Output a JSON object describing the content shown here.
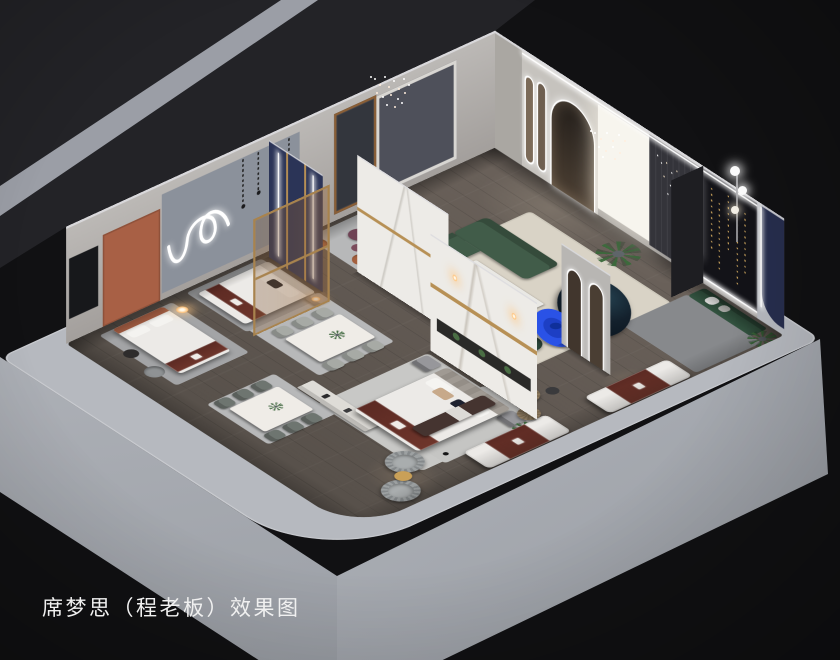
{
  "caption": "席梦思（程老板）效果图",
  "palette": {
    "bg_black": "#111113",
    "bg_charcoal": "#232327",
    "ground_strip": "#9b9ea6",
    "slab": "#b6b9bf",
    "slab_face_sw": "#989ca3",
    "slab_face_se": "#c0c3c9",
    "wood_floor": "#6a615a",
    "wood_dark": "#57504a",
    "wall_light": "#b9b6b3",
    "wall_panel_gray": "#8b919b",
    "white_panel": "#f7f5ee",
    "drape_gray": "#34343a",
    "art_black": "#131318",
    "navy_wall": "#272e4e",
    "navy_panel": "#2b3457",
    "marble_white": "#edebe7",
    "gold": "#b79055",
    "wood_frame": "#8a5f37",
    "rug_cream": "#d9d3c6",
    "rug_gray": "#b7b8b9",
    "rug_dark": "#87898c",
    "sofa_green": "#415c49",
    "gallery_green": "#32523f",
    "sofa_navy": "#13202c",
    "cobalt": "#2a52e6",
    "maroon": "#5c2a23",
    "bench_pink": "#9c6265",
    "plum": "#6f4254",
    "terracotta": "#a86045",
    "rust": "#a5603e",
    "swivel_gray": "#9da1a2",
    "chair_gray": "#a7aaa5",
    "pouf_tan": "#8d7a5f",
    "bed_white": "#eceae7",
    "nightstand": "#97979b",
    "lamp_warm": "#ffc27a"
  }
}
